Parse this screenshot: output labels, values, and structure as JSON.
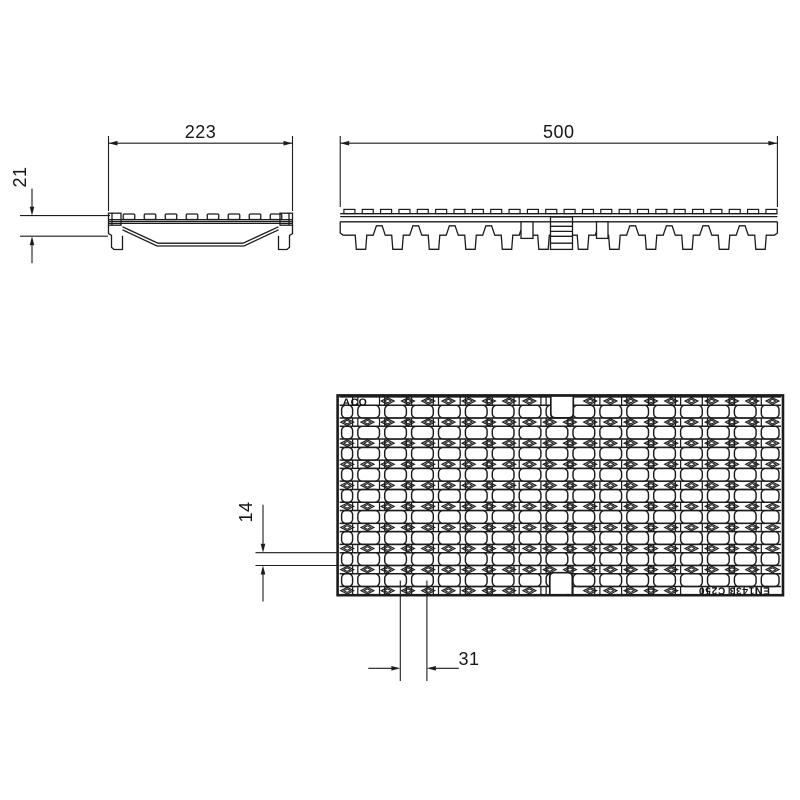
{
  "drawing": {
    "description": "Technical drawing of ACO drainage channel grating, three views",
    "background": "#ffffff",
    "line_color": "#1c1c1c",
    "text_color": "#161616"
  },
  "labels": {
    "brand": "ACO",
    "standard": "EN1433 C250"
  },
  "dimensions": {
    "grate_width": "223",
    "grate_height": "21",
    "grate_length": "500",
    "slot_height": "14",
    "slot_pitch": "31"
  },
  "plan_pattern": {
    "band_rows": 10,
    "slot_rows": 9,
    "bar_columns": 16,
    "diamonds_per_row": 22
  },
  "side_profile": {
    "studs": 24,
    "feet": 12
  },
  "end_profile": {
    "studs": 8
  }
}
